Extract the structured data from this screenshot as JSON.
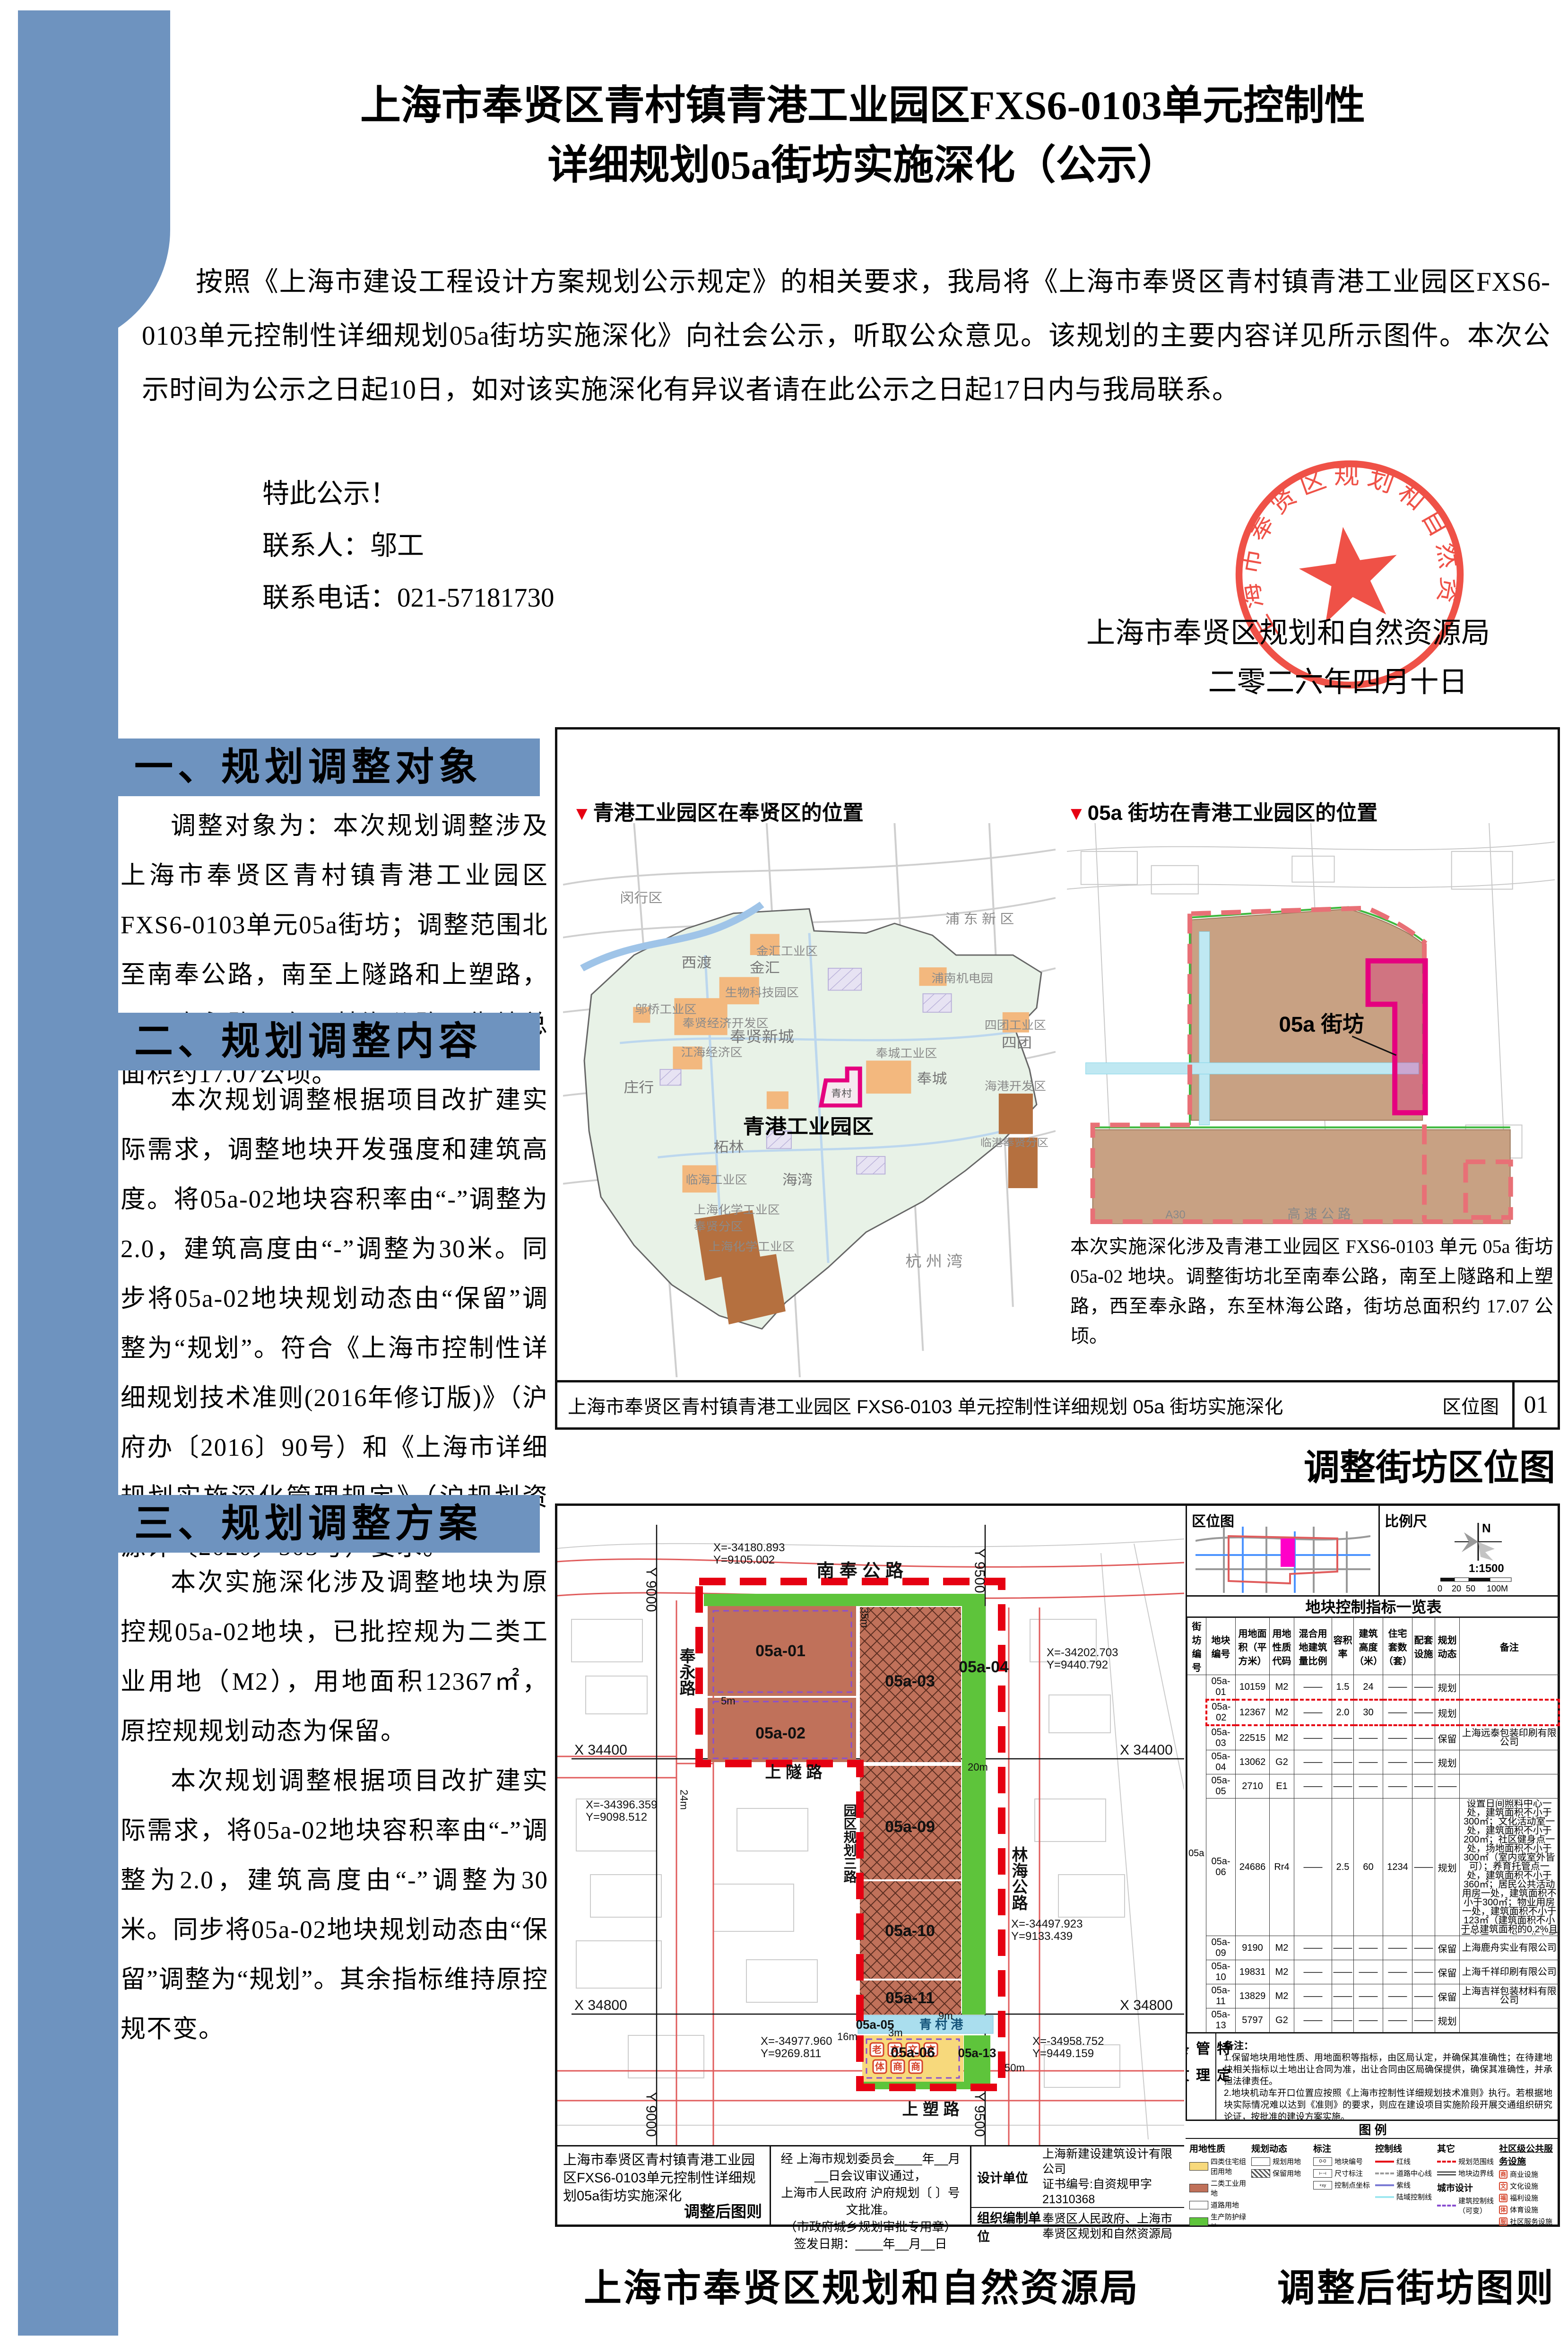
{
  "page": {
    "title_line1": "上海市奉贤区青村镇青港工业园区FXS6-0103单元控制性",
    "title_line2": "详细规划05a街坊实施深化（公示）",
    "intro": "按照《上海市建设工程设计方案规划公示规定》的相关要求，我局将《上海市奉贤区青村镇青港工业园区FXS6-0103单元控制性详细规划05a街坊实施深化》向社会公示，听取公众意见。该规划的主要内容详见所示图件。本次公示时间为公示之日起10日，如对该实施深化有异议者请在此公示之日起17日内与我局联系。",
    "notice": "特此公示！",
    "contact_person": "联系人：邬工",
    "contact_phone": "联系电话：021-57181730",
    "signature_org": "上海市奉贤区规划和自然资源局",
    "signature_date": "二零二六年四月十日",
    "seal_text": "上海市奉贤区规划和自然资源局",
    "seal_color": "#ee4338"
  },
  "sections": [
    {
      "heading": "一、规划调整对象",
      "paragraphs": [
        "调整对象为：本次规划调整涉及上海市奉贤区青村镇青港工业园区FXS6-0103单元05a街坊；调整范围北至南奉公路，南至上隧路和上塑路，西至奉永路，东至林海公路，街坊总面积约17.07公顷。"
      ]
    },
    {
      "heading": "二、规划调整内容",
      "paragraphs": [
        "本次规划调整根据项目改扩建实际需求，调整地块开发强度和建筑高度。将05a-02地块容积率由“-”调整为2.0，建筑高度由“-”调整为30米。同步将05a-02地块规划动态由“保留”调整为“规划”。符合《上海市控制性详细规划技术准则(2016年修订版)》（沪府办〔2016〕90号）和《上海市详细规划实施深化管理规定》（沪规划资源详〔2020〕503号）要求。"
      ]
    },
    {
      "heading": "三、规划调整方案",
      "paragraphs": [
        "本次实施深化涉及调整地块为原控规05a-02地块，已批控规为二类工业用地（M2），用地面积12367㎡，原控规规划动态为保留。",
        "本次规划调整根据项目改扩建实际需求，将05a-02地块容积率由“-”调整为2.0，建筑高度由“-”调整为30米。同步将05a-02地块规划动态由“保留”调整为“规划”。其余指标维持原控规不变。"
      ]
    }
  ],
  "map1": {
    "marker_left": "青港工业园区在奉贤区的位置",
    "marker_right": "05a 街坊在青港工业园区的位置",
    "labels": [
      "闵行区",
      "浦 东 新 区",
      "西渡",
      "金汇工业区",
      "金汇",
      "浦南机电园",
      "生物科技园区",
      "邬桥工业区",
      "奉贤经济开发区",
      "奉贤新城",
      "江海经济区",
      "庄行",
      "四团工业区",
      "四团",
      "奉城工业区",
      "奉城",
      "海港开发区",
      "临港奉贤分区",
      "柘林",
      "临海工业区",
      "海湾",
      "上海化学工业区",
      "奉贤分区",
      "上海化学工业区",
      "杭  州  湾",
      "青村"
    ],
    "highlight_label": "青港工业园区",
    "block_label": "05a 街坊",
    "expressway": "A30",
    "expressway2": "高  速  公  路",
    "note": "本次实施深化涉及青港工业园区 FXS6-0103 单元 05a 街坊 05a-02 地块。调整街坊北至南奉公路，南至上隧路和上塑路，西至奉永路，东至林海公路，街坊总面积约 17.07 公顷。",
    "bar_title": "上海市奉贤区青村镇青港工业园区 FXS6-0103 单元控制性详细规划 05a 街坊实施深化",
    "bar_sheet": "区位图",
    "bar_no": "01",
    "caption": "调整街坊区位图"
  },
  "map2": {
    "inset_title": "区位图",
    "scale_title": "比例尺",
    "north": "N",
    "scale_ratio": "1:1500",
    "scale_ticks": [
      "0",
      "20",
      "50",
      "100M"
    ],
    "table_title": "地块控制指标一览表",
    "block_no": "05a",
    "columns": [
      "街坊编号",
      "地块编号",
      "用地面积（平方米）",
      "用地性质代码",
      "混合用地建筑量比例",
      "容积率",
      "建筑高度（米）",
      "住宅套数（套）",
      "配套设施",
      "规划动态",
      "备注"
    ],
    "rows": [
      [
        "05a-01",
        "10159",
        "M2",
        "——",
        "1.5",
        "24",
        "——",
        "——",
        "规划",
        ""
      ],
      [
        "05a-02",
        "12367",
        "M2",
        "——",
        "2.0",
        "30",
        "——",
        "——",
        "规划",
        ""
      ],
      [
        "05a-03",
        "22515",
        "M2",
        "——",
        "——",
        "——",
        "——",
        "——",
        "保留",
        "上海远泰包装印刷有限公司"
      ],
      [
        "05a-04",
        "13062",
        "G2",
        "——",
        "——",
        "——",
        "——",
        "——",
        "规划",
        ""
      ],
      [
        "05a-05",
        "2710",
        "E1",
        "——",
        "——",
        "——",
        "——",
        "——",
        "——",
        ""
      ],
      [
        "05a-06",
        "24686",
        "Rr4",
        "——",
        "2.5",
        "60",
        "1234",
        "——",
        "规划",
        "设置日间照料中心一处，建筑面积不小于300㎡；文化活动室一处，建筑面积不小于200㎡；社区健身点一处，场地面积不小于300㎡（室内或室外皆可）；养育托管点一处，建筑面积不小于360㎡；居民公共活动用房一处，建筑面积不小于300㎡；物业用房一处，建筑面积不小于123㎡（建筑面积不小于总建筑面积的0.2%且不小于100㎡）；业主委员会用房一处，建筑面积不小于30㎡；生活服务点一处，建筑面积不低于100㎡；社区食堂一处，建筑面积不小于200㎡"
      ],
      [
        "05a-09",
        "9190",
        "M2",
        "——",
        "——",
        "——",
        "——",
        "——",
        "保留",
        "上海鹿舟实业有限公司"
      ],
      [
        "05a-10",
        "19831",
        "M2",
        "——",
        "——",
        "——",
        "——",
        "——",
        "保留",
        "上海千祥印刷有限公司"
      ],
      [
        "05a-11",
        "13829",
        "M2",
        "——",
        "——",
        "——",
        "——",
        "——",
        "保留",
        "上海吉祥包装材料有限公司"
      ],
      [
        "05a-13",
        "5797",
        "G2",
        "——",
        "——",
        "——",
        "——",
        "——",
        "规划",
        ""
      ]
    ],
    "notes_title": "备注：",
    "notes": [
      "1.保留地块用地性质、用地面积等指标，由区局认定，并确保其准确性；在待建地块相关指标以土地出让合同为准，出让合同由区局确保提供，确保其准确性，并承担法律责任。",
      "2.地块机动车开口位置应按照《上海市控制性详细规划技术准则》执行。若根据地块实际情况难以达到《准则》的要求，则应在建设项目实施阶段开展交通组织研究论证，按批准的建设方案实施。",
      "3.公共服务配套设施需布局在建筑物二层以下位置，且临街布置，方便到达。",
      "4.日间照料中心、文化活动室、养育托管点、生活服务点、居民公共活动用房建成后产权移交镇政府；社区健身点、社区食堂、物业用房、业主委员会用房建成后由产权人自持。"
    ],
    "side_label": "特定管理条文",
    "legend_title": "图  例",
    "legend": {
      "g1_title": "用地性质",
      "g1": [
        {
          "code": "Rr4",
          "label": "四类住宅组团用地",
          "color": "#f7d97c"
        },
        {
          "code": "M2",
          "label": "二类工业用地",
          "color": "#c0715a"
        },
        {
          "code": "S1",
          "label": "道路用地",
          "color": "#ffffff"
        },
        {
          "code": "G2",
          "label": "生产防护绿地",
          "color": "#5ec43b"
        },
        {
          "code": "E1",
          "label": "水域",
          "color": "#aadeee"
        }
      ],
      "g2_title": "规划动态",
      "g2": [
        "规划用地",
        "保留用地"
      ],
      "g3_title": "标注",
      "g3": [
        "地块编号",
        "尺寸标注",
        "控制点坐标"
      ],
      "g4_title": "控制线",
      "g4": [
        "红线",
        "道路中心线",
        "紫线",
        "陆域控制线"
      ],
      "g5_title": "其它",
      "g5": [
        "规划范围线",
        "地块边界线"
      ],
      "g6_title": "城市设计",
      "g6": [
        "建筑控制线（可变）"
      ],
      "g7_title": "社区级公共服务设施",
      "g7": [
        "商业设施",
        "文化设施",
        "福利设施",
        "体育设施",
        "社区服务设施"
      ]
    },
    "plan": {
      "roads": [
        "南  奉  公  路",
        "奉永路",
        "上 隧 路",
        "林海公路",
        "园区规划三路",
        "上 塑 路"
      ],
      "canal": "青 村 港",
      "parcels": [
        "05a-01",
        "05a-02",
        "05a-03",
        "05a-04",
        "05a-09",
        "05a-10",
        "05a-11",
        "05a-05",
        "05a-06",
        "05a-13"
      ],
      "grid": [
        "Y 9000",
        "Y 9500",
        "X 34400",
        "X 34800"
      ],
      "coords": [
        {
          "x": "X=-34180.893",
          "y": "Y=9105.002"
        },
        {
          "x": "X=-34202.703",
          "y": "Y=9440.792"
        },
        {
          "x": "X=-34396.359",
          "y": "Y=9098.512"
        },
        {
          "x": "X=-34497.923",
          "y": "Y=9133.439"
        },
        {
          "x": "X=-34977.960",
          "y": "Y=9269.811"
        },
        {
          "x": "X=-34958.752",
          "y": "Y=9449.159"
        }
      ],
      "dims": [
        "24m",
        "35m",
        "5m",
        "20m",
        "16m",
        "3m",
        "9m",
        "50m"
      ],
      "icons": [
        "老",
        "文",
        "文",
        "文",
        "体",
        "商",
        "商",
        "服",
        "服"
      ]
    },
    "titleblock": {
      "project": "上海市奉贤区青村镇青港工业园区FXS6-0103单元控制性详细规划05a街坊实施深化",
      "sheet": "调整后图则",
      "approval1": "经  上海市规划委员会____年__月__日会议审议通过，",
      "approval2": "上海市人民政府    沪府规划〔      〕号文批准。",
      "approval3": "（市政府城乡规划审批专用章）",
      "approval4": "签发日期：____年__月__日",
      "design_label": "设计单位",
      "design_value": "上海新建设建筑设计有限公司",
      "design_cert": "证书编号:自资规甲字21310368",
      "org_label": "组织编制单位",
      "org_value": "奉贤区人民政府、上海市奉贤区规划和自然资源局"
    },
    "caption_left": "上海市奉贤区规划和自然资源局",
    "caption_right": "调整后街坊图则"
  }
}
